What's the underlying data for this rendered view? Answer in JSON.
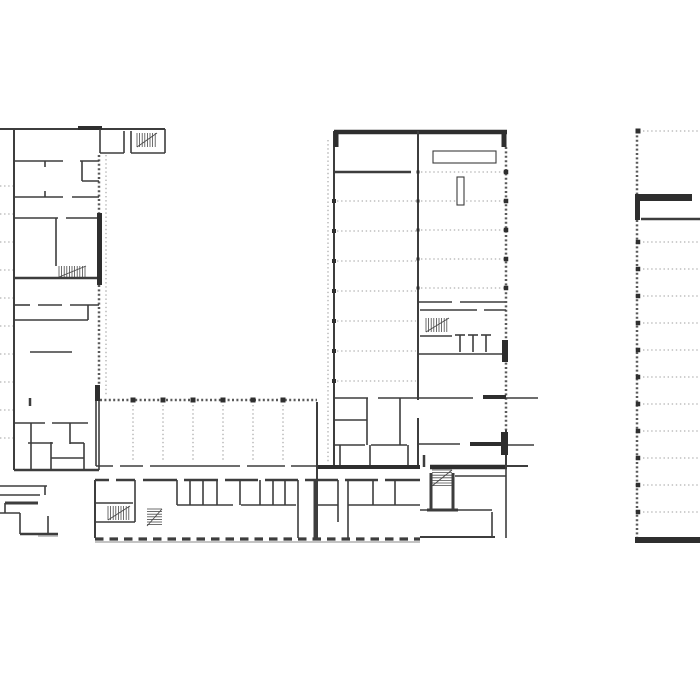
{
  "canvas": {
    "width": 700,
    "height": 700,
    "background": "#ffffff"
  },
  "palette": {
    "wall": "#3d3d3d",
    "wall_dark": "#2e2e2e",
    "ticked": "#5a5a5a",
    "dotted": "#9e9e9e",
    "column": "#2f2f2f",
    "stair": "#4a4a4a",
    "shade": "#c4c4c4",
    "paper": "#ffffff"
  },
  "plan": {
    "walls": [
      [
        0,
        129,
        165,
        129,
        2
      ],
      [
        78,
        128,
        102,
        128,
        4
      ],
      [
        100,
        129,
        100,
        153
      ],
      [
        124,
        131,
        124,
        153
      ],
      [
        131,
        131,
        131,
        153
      ],
      [
        165,
        129,
        165,
        153
      ],
      [
        100,
        153,
        124,
        153
      ],
      [
        131,
        153,
        165,
        153
      ],
      [
        14,
        129,
        14,
        470,
        2
      ],
      [
        14,
        161,
        63,
        161
      ],
      [
        80,
        161,
        99,
        161
      ],
      [
        82,
        161,
        82,
        181
      ],
      [
        82,
        181,
        99,
        181
      ],
      [
        45,
        161,
        45,
        167
      ],
      [
        45,
        191,
        45,
        197
      ],
      [
        14,
        197,
        63,
        197
      ],
      [
        72,
        197,
        99,
        197
      ],
      [
        14,
        218,
        58,
        218
      ],
      [
        66,
        218,
        99,
        218
      ],
      [
        56,
        218,
        56,
        266
      ],
      [
        14,
        278,
        99,
        278,
        2.5
      ],
      [
        14,
        305,
        30,
        305
      ],
      [
        38,
        305,
        62,
        305
      ],
      [
        70,
        305,
        99,
        305
      ],
      [
        88,
        305,
        88,
        320
      ],
      [
        14,
        320,
        88,
        320
      ],
      [
        30,
        352,
        72,
        352
      ],
      [
        30,
        398,
        30,
        406,
        2.5
      ],
      [
        14,
        423,
        45,
        423
      ],
      [
        52,
        423,
        88,
        423
      ],
      [
        31,
        423,
        31,
        470
      ],
      [
        51,
        442,
        51,
        470
      ],
      [
        70,
        423,
        70,
        444
      ],
      [
        84,
        443,
        84,
        470
      ],
      [
        28,
        443,
        53,
        443
      ],
      [
        70,
        443,
        84,
        443
      ],
      [
        51,
        458,
        84,
        458
      ],
      [
        14,
        470,
        99,
        470,
        2.5
      ],
      [
        99,
        400,
        99,
        470
      ],
      [
        0,
        486,
        47,
        486
      ],
      [
        45,
        486,
        45,
        495
      ],
      [
        0,
        495,
        40,
        495
      ],
      [
        5,
        503,
        38,
        503,
        3
      ],
      [
        5,
        503,
        5,
        513
      ],
      [
        0,
        513,
        20,
        513
      ],
      [
        20,
        513,
        20,
        534
      ],
      [
        48,
        516,
        48,
        534
      ],
      [
        20,
        534,
        58,
        534,
        2.5
      ],
      [
        96,
        400,
        96,
        466
      ],
      [
        96,
        466,
        113,
        466
      ],
      [
        120,
        466,
        143,
        466
      ],
      [
        150,
        466,
        240,
        466
      ],
      [
        247,
        466,
        285,
        466
      ],
      [
        291,
        466,
        317,
        466
      ],
      [
        317,
        402,
        317,
        538,
        2
      ],
      [
        95,
        480,
        109,
        480,
        2.5
      ],
      [
        116,
        480,
        135,
        480,
        2.5
      ],
      [
        143,
        480,
        177,
        480,
        2.5
      ],
      [
        184,
        480,
        218,
        480,
        2.5
      ],
      [
        225,
        480,
        258,
        480,
        2.5
      ],
      [
        265,
        480,
        298,
        480,
        2.5
      ],
      [
        305,
        480,
        338,
        480,
        2.5
      ],
      [
        345,
        480,
        378,
        480,
        2.5
      ],
      [
        385,
        480,
        420,
        480,
        2.5
      ],
      [
        95,
        480,
        95,
        538,
        2
      ],
      [
        135,
        480,
        135,
        522
      ],
      [
        95,
        503,
        133,
        503
      ],
      [
        95,
        522,
        135,
        522
      ],
      [
        177,
        480,
        177,
        505
      ],
      [
        190,
        480,
        190,
        505
      ],
      [
        203,
        480,
        203,
        505
      ],
      [
        217,
        480,
        217,
        505
      ],
      [
        240,
        480,
        240,
        505
      ],
      [
        260,
        480,
        260,
        505
      ],
      [
        273,
        480,
        273,
        505
      ],
      [
        285,
        480,
        285,
        505
      ],
      [
        298,
        480,
        298,
        538
      ],
      [
        315,
        480,
        315,
        538,
        3
      ],
      [
        338,
        480,
        338,
        522
      ],
      [
        348,
        480,
        348,
        538
      ],
      [
        373,
        480,
        373,
        505
      ],
      [
        395,
        480,
        395,
        505
      ],
      [
        177,
        505,
        233,
        505
      ],
      [
        241,
        505,
        296,
        505
      ],
      [
        318,
        505,
        338,
        505
      ],
      [
        348,
        505,
        420,
        505
      ],
      [
        334,
        398,
        368,
        398
      ],
      [
        378,
        398,
        418,
        398
      ],
      [
        367,
        398,
        367,
        445
      ],
      [
        400,
        398,
        400,
        445
      ],
      [
        335,
        420,
        367,
        420
      ],
      [
        334,
        445,
        365,
        445
      ],
      [
        371,
        445,
        407,
        445
      ],
      [
        340,
        445,
        340,
        467
      ],
      [
        370,
        445,
        370,
        467
      ],
      [
        408,
        445,
        408,
        467
      ],
      [
        334,
        131,
        334,
        467,
        2
      ],
      [
        334,
        132,
        507,
        132,
        4.5
      ],
      [
        336,
        132,
        336,
        147,
        5
      ],
      [
        504,
        132,
        504,
        147,
        5
      ],
      [
        334,
        172,
        411,
        172,
        2.5
      ],
      [
        418,
        131,
        418,
        400,
        2
      ],
      [
        418,
        418,
        418,
        467,
        2
      ],
      [
        419,
        302,
        452,
        302
      ],
      [
        460,
        302,
        505,
        302
      ],
      [
        420,
        310,
        477,
        310
      ],
      [
        484,
        310,
        506,
        310
      ],
      [
        420,
        336,
        452,
        336
      ],
      [
        455,
        335,
        465,
        335
      ],
      [
        460,
        335,
        460,
        352
      ],
      [
        468,
        335,
        478,
        335
      ],
      [
        473,
        335,
        473,
        352
      ],
      [
        481,
        335,
        491,
        335
      ],
      [
        486,
        335,
        486,
        352
      ],
      [
        419,
        354,
        506,
        354
      ],
      [
        419,
        398,
        473,
        398
      ],
      [
        483,
        397,
        506,
        397,
        4
      ],
      [
        419,
        444,
        460,
        444
      ],
      [
        470,
        444,
        506,
        444,
        4
      ],
      [
        318,
        467,
        420,
        467,
        4
      ],
      [
        430,
        467,
        507,
        467,
        4.5
      ],
      [
        424,
        455,
        424,
        467,
        2.5
      ],
      [
        431,
        473,
        431,
        510,
        3
      ],
      [
        453,
        473,
        453,
        510,
        3
      ],
      [
        427,
        510,
        458,
        510,
        3
      ],
      [
        420,
        510,
        492,
        510
      ],
      [
        492,
        512,
        492,
        537
      ],
      [
        420,
        537,
        495,
        537,
        2
      ],
      [
        455,
        476,
        506,
        476
      ],
      [
        506,
        430,
        506,
        467,
        2
      ],
      [
        506,
        467,
        506,
        538,
        1.6
      ],
      [
        506,
        398,
        538,
        398
      ],
      [
        506,
        445,
        534,
        445
      ],
      [
        507,
        466,
        528,
        466,
        2
      ],
      [
        641,
        219,
        700,
        219,
        2.5
      ]
    ],
    "ticked_walls": [
      [
        99,
        155,
        99,
        213
      ],
      [
        99,
        285,
        99,
        385
      ],
      [
        100,
        400,
        317,
        400
      ],
      [
        506,
        147,
        506,
        430
      ],
      [
        637,
        131,
        637,
        194
      ],
      [
        637,
        220,
        637,
        537
      ]
    ],
    "thick_rects": [
      [
        97,
        213,
        5,
        72
      ],
      [
        95,
        385,
        5,
        16
      ],
      [
        635,
        194,
        57,
        7
      ],
      [
        635,
        194,
        5,
        26
      ],
      [
        635,
        537,
        65,
        6
      ],
      [
        501,
        432,
        7,
        23
      ],
      [
        502,
        340,
        6,
        22
      ]
    ],
    "dotted_lines": [
      [
        0,
        186,
        13,
        186
      ],
      [
        0,
        214,
        13,
        214
      ],
      [
        0,
        242,
        13,
        242
      ],
      [
        0,
        270,
        13,
        270
      ],
      [
        0,
        298,
        13,
        298
      ],
      [
        0,
        326,
        13,
        326
      ],
      [
        0,
        354,
        13,
        354
      ],
      [
        0,
        382,
        13,
        382
      ],
      [
        0,
        410,
        13,
        410
      ],
      [
        0,
        438,
        13,
        438
      ],
      [
        106,
        155,
        106,
        395
      ],
      [
        328,
        140,
        328,
        462
      ],
      [
        337,
        201,
        416,
        201
      ],
      [
        337,
        231,
        416,
        231
      ],
      [
        337,
        261,
        416,
        261
      ],
      [
        337,
        291,
        416,
        291
      ],
      [
        337,
        321,
        416,
        321
      ],
      [
        337,
        351,
        416,
        351
      ],
      [
        337,
        381,
        416,
        381
      ],
      [
        421,
        172,
        504,
        172
      ],
      [
        421,
        201,
        504,
        201
      ],
      [
        421,
        230,
        504,
        230
      ],
      [
        421,
        259,
        504,
        259
      ],
      [
        421,
        288,
        504,
        288
      ],
      [
        133,
        405,
        133,
        462
      ],
      [
        163,
        405,
        163,
        462
      ],
      [
        193,
        405,
        193,
        462
      ],
      [
        223,
        405,
        223,
        462
      ],
      [
        253,
        405,
        253,
        462
      ],
      [
        283,
        405,
        283,
        462
      ],
      [
        643,
        131,
        700,
        131
      ],
      [
        643,
        242,
        700,
        242
      ],
      [
        643,
        269,
        700,
        269
      ],
      [
        643,
        296,
        700,
        296
      ],
      [
        643,
        323,
        700,
        323
      ],
      [
        643,
        350,
        700,
        350
      ],
      [
        643,
        377,
        700,
        377
      ],
      [
        643,
        404,
        700,
        404
      ],
      [
        643,
        431,
        700,
        431
      ],
      [
        643,
        458,
        700,
        458
      ],
      [
        643,
        485,
        700,
        485
      ],
      [
        643,
        512,
        700,
        512
      ]
    ],
    "dashed_walls": [
      [
        95,
        539,
        420,
        539
      ]
    ],
    "columns": [
      [
        133,
        400,
        5
      ],
      [
        163,
        400,
        5
      ],
      [
        193,
        400,
        5
      ],
      [
        223,
        400,
        5
      ],
      [
        253,
        400,
        5
      ],
      [
        283,
        400,
        5
      ],
      [
        334,
        201,
        4
      ],
      [
        334,
        231,
        4
      ],
      [
        334,
        261,
        4
      ],
      [
        334,
        291,
        4
      ],
      [
        334,
        321,
        4
      ],
      [
        334,
        351,
        4
      ],
      [
        334,
        381,
        4
      ],
      [
        506,
        172,
        4.5
      ],
      [
        506,
        201,
        4.5
      ],
      [
        506,
        230,
        4.5
      ],
      [
        506,
        259,
        4.5
      ],
      [
        506,
        288,
        4.5
      ],
      [
        418,
        172,
        3
      ],
      [
        418,
        201,
        3
      ],
      [
        418,
        230,
        3
      ],
      [
        418,
        259,
        3
      ],
      [
        418,
        288,
        3
      ],
      [
        638,
        131,
        5
      ],
      [
        638,
        242,
        4.5
      ],
      [
        638,
        269,
        4.5
      ],
      [
        638,
        296,
        4.5
      ],
      [
        638,
        323,
        4.5
      ],
      [
        638,
        350,
        4.5
      ],
      [
        638,
        377,
        4.5
      ],
      [
        638,
        404,
        4.5
      ],
      [
        638,
        431,
        4.5
      ],
      [
        638,
        458,
        4.5
      ],
      [
        638,
        485,
        4.5
      ],
      [
        638,
        512,
        4.5
      ]
    ],
    "shades": [
      [
        95,
        541,
        325,
        2
      ],
      [
        38,
        534,
        20,
        3
      ]
    ],
    "stairs": [
      {
        "x": 137,
        "y": 133,
        "w": 20,
        "h": 14,
        "dir": "h"
      },
      {
        "x": 59,
        "y": 266,
        "w": 27,
        "h": 11,
        "dir": "h"
      },
      {
        "x": 108,
        "y": 506,
        "w": 22,
        "h": 14,
        "dir": "h"
      },
      {
        "x": 147,
        "y": 509,
        "w": 15,
        "h": 17,
        "dir": "v"
      },
      {
        "x": 426,
        "y": 318,
        "w": 23,
        "h": 14,
        "dir": "h"
      },
      {
        "x": 432,
        "y": 470,
        "w": 20,
        "h": 16,
        "dir": "v"
      }
    ],
    "outline_rects": [
      [
        433,
        151,
        63,
        12
      ],
      [
        457,
        177,
        7,
        28
      ]
    ]
  }
}
